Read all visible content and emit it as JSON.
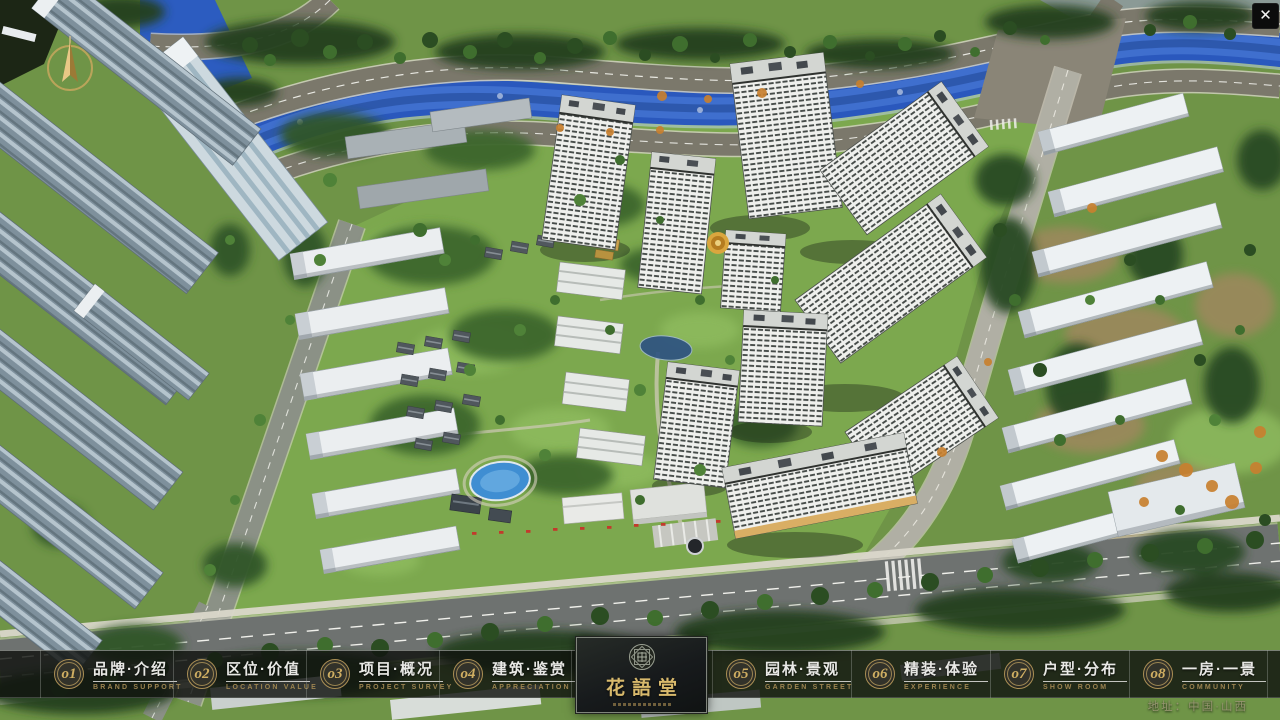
{
  "colors": {
    "accent_gold": "#c9a85f",
    "subtitle_gold": "#9c8450",
    "bar_background": "rgba(16,18,15,0.82)",
    "river_blue": "#2a58bd",
    "panel_title_gold": "#d8b96c"
  },
  "window": {
    "close_label": "✕"
  },
  "navbar": {
    "items": [
      {
        "num": "o1",
        "title": "品牌·介绍",
        "subtitle": "BRAND SUPPORT"
      },
      {
        "num": "o2",
        "title": "区位·价值",
        "subtitle": "LOCATION VALUE"
      },
      {
        "num": "o3",
        "title": "项目·概况",
        "subtitle": "PROJECT SURVEY"
      },
      {
        "num": "o4",
        "title": "建筑·鉴赏",
        "subtitle": "APPRECIATION"
      },
      {
        "num": "o5",
        "title": "园林·景观",
        "subtitle": "GARDEN STREET"
      },
      {
        "num": "o6",
        "title": "精装·体验",
        "subtitle": "EXPERIENCE"
      },
      {
        "num": "o7",
        "title": "户型·分布",
        "subtitle": "SHOW ROOM"
      },
      {
        "num": "o8",
        "title": "一房·一景",
        "subtitle": "COMMUNITY"
      }
    ]
  },
  "logo": {
    "title": "花語堂"
  },
  "footer": {
    "address": "地址：中国·山西"
  }
}
